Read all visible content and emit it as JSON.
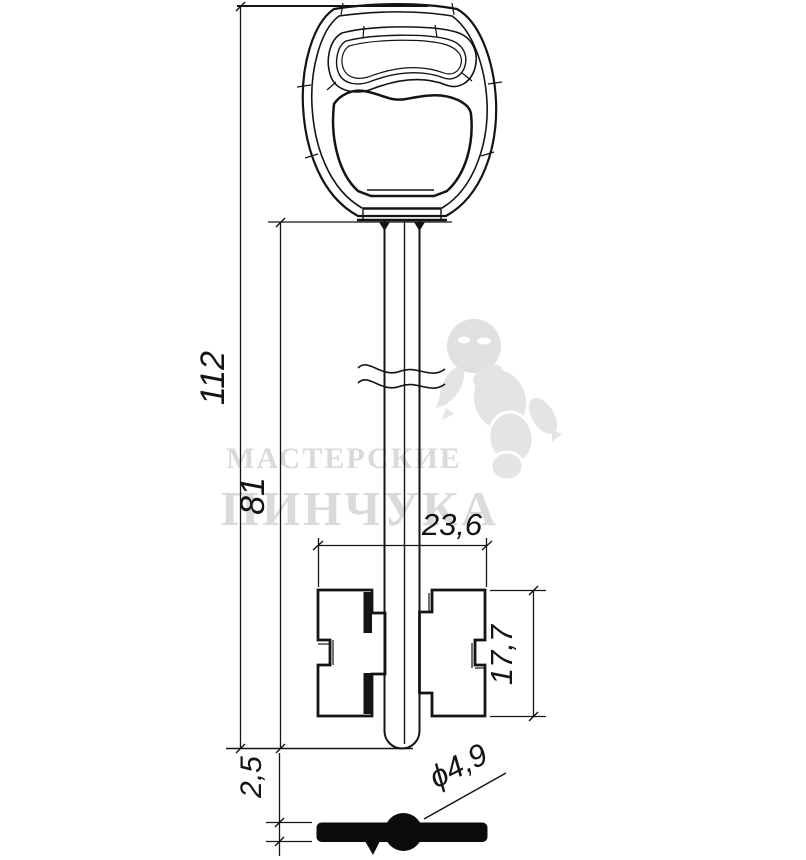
{
  "dimensions": {
    "total_length": "112",
    "shaft_length": "81",
    "bit_width": "23,6",
    "bit_height": "17,7",
    "bit_thickness": "2,5",
    "tip_diameter": "ϕ4,9"
  },
  "watermark": {
    "line1": "МАСТЕРСКИЕ",
    "line2": "ПИНЧУКА"
  },
  "colors": {
    "line": "#141414",
    "watermark_gray": "#dadada"
  }
}
